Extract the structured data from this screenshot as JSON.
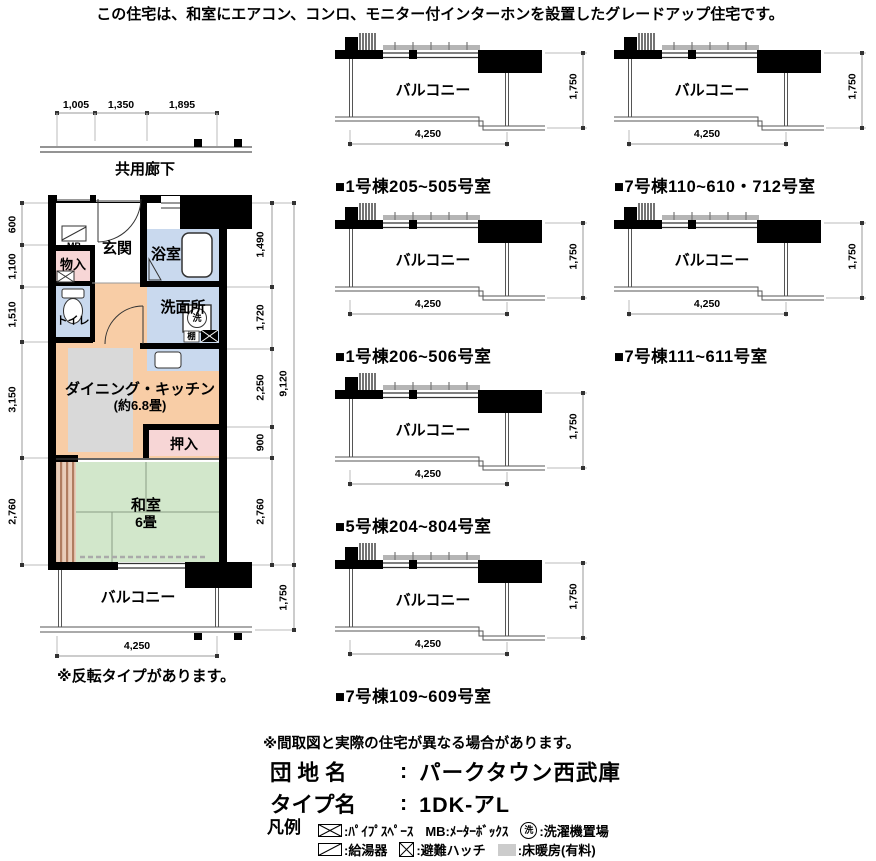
{
  "header": {
    "note": "この住宅は、和室にエアコン、コンロ、モニター付インターホンを設置したグレードアップ住宅です。"
  },
  "floor_plan": {
    "corridor_label": "共用廊下",
    "top_dims": [
      "1,005",
      "1,350",
      "1,895"
    ],
    "left_dims": [
      "600",
      "1,100",
      "1,510",
      "3,150",
      "2,760"
    ],
    "right_dims": [
      "1,490",
      "1,720",
      "2,250",
      "900",
      "2,760"
    ],
    "right_total_dim": "9,120",
    "balcony_depth_dim": "1,750",
    "width_dim": "4,250",
    "rooms": {
      "mb": "MB",
      "storage": "物入",
      "entrance": "玄関",
      "bathroom": "浴室",
      "washroom": "洗面所",
      "toilet": "トイレ",
      "dining_kitchen": "ダイニング・キッチン",
      "dining_kitchen_size": "(約6.8畳)",
      "closet": "押入",
      "tatami_room": "和室",
      "tatami_room_size": "6畳",
      "balcony": "バルコニー",
      "shelf": "棚",
      "laundry": "洗"
    },
    "reverse_note": "※反転タイプがあります。"
  },
  "balcony_diagrams": {
    "balcony_label": "バルコニー",
    "width_dim": "4,250",
    "depth_dim": "1,750",
    "items": [
      {
        "label": "■1号棟205~505号室"
      },
      {
        "label": "■7号棟110~610・712号室"
      },
      {
        "label": "■1号棟206~506号室"
      },
      {
        "label": "■7号棟111~611号室"
      },
      {
        "label": "■5号棟204~804号室"
      },
      {
        "label": "■7号棟109~609号室"
      }
    ]
  },
  "footer": {
    "disclaimer": "※間取図と実際の住宅が異なる場合があります。",
    "estate_label": "団 地 名",
    "estate_sep": ":",
    "estate_name": "パークタウン西武庫",
    "type_label": "タイプ名",
    "type_sep": ":",
    "type_name": "1DK-アL",
    "legend_title": "凡例",
    "legend": {
      "pipe_space": ":ﾊﾟｲﾌﾟｽﾍﾟｰｽ",
      "meter_box": "MB:ﾒｰﾀｰﾎﾞｯｸｽ",
      "laundry_symbol": "洗",
      "laundry_place": ":洗濯機置場",
      "water_heater": ":給湯器",
      "escape_hatch": ":避難ハッチ",
      "floor_heating": ":床暖房(有料)"
    }
  },
  "colors": {
    "wall": "#000000",
    "room_blue": "#c9d9ee",
    "room_pink": "#f7d6d6",
    "room_peach": "#f8cda6",
    "room_green": "#d2e7cb",
    "floor_heat": "#d9d9d9",
    "railing": "#b5b5b5",
    "dim_line": "#999999"
  }
}
